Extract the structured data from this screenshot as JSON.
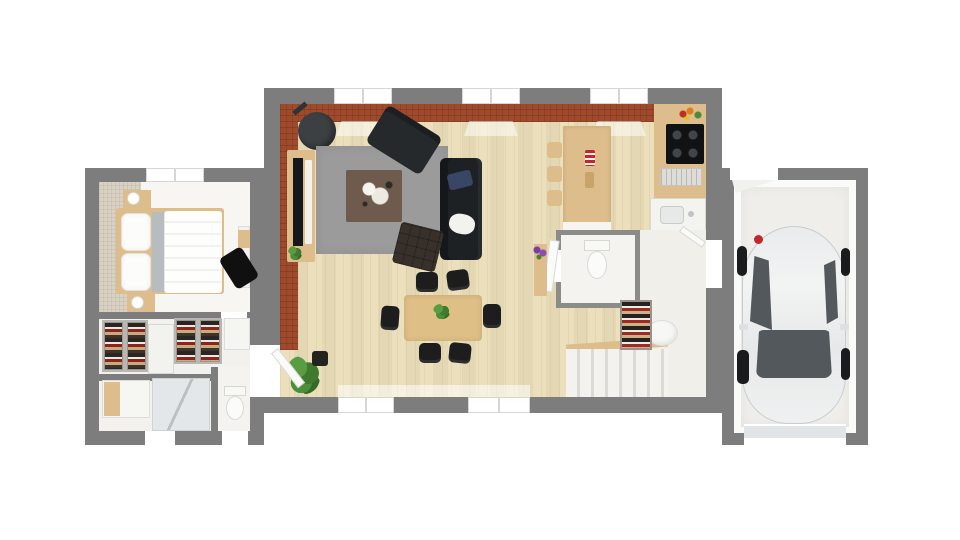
{
  "title": "3D rendered floor plan of a single-storey house with attached garage",
  "colors": {
    "wall": "#7d7d7d",
    "wood_floor": "#eaddb8",
    "brick": "#a04a2c",
    "rug_living": "#9b9b9b",
    "rug_bedroom": "#d9d1c2",
    "bedroom_floor": "#f7f6f3",
    "suite_floor": "#f2f1ed",
    "hall_floor": "#f1efea",
    "garage_floor": "#efeeeb",
    "garage_door": "#e2e5e7",
    "car_body": "#ebedee",
    "car_glass": "#53585c",
    "wheel": "#1a1b1d",
    "sofa": "#26292c",
    "sofa2": "#1e2124",
    "ottoman": "#38302b",
    "coffee_table": "#6e5b4e",
    "wood": "#dcbd8b",
    "dining_table": "#debf86",
    "chair": "#1d1d1d",
    "plant": "#4a8a38",
    "stove": "#3c4043",
    "cooktop": "#101214",
    "logo_red": "#c1272d",
    "pillow_blue": "#3a4666",
    "blanket_gray": "#b7bcc0",
    "shower_glass": "#e3e7e9",
    "stairs_step": "#dcdad4",
    "stairs_bg": "#f3f2ee",
    "window_frame": "#d6d6d2"
  },
  "rooms": [
    {
      "id": "living-dining",
      "furniture": [
        "wood-stove",
        "tv-console",
        "area-rug",
        "coffee-table",
        "two-seat-sofa",
        "three-seat-sofa",
        "ottoman",
        "dining-table",
        "6 dining-chairs",
        "potted-plant"
      ]
    },
    {
      "id": "kitchen",
      "furniture": [
        "island",
        "3 bar-stools",
        "counter",
        "cooktop",
        "dish-rack",
        "sink",
        "vegetables"
      ]
    },
    {
      "id": "bedroom",
      "furniture": [
        "double-bed",
        "2 nightstands",
        "2 lamps",
        "desk",
        "desk-chair",
        "rug"
      ]
    },
    {
      "id": "dressing",
      "furniture": [
        "2 wardrobes",
        "sliding-door"
      ]
    },
    {
      "id": "bathroom",
      "furniture": [
        "vanity",
        "shower",
        "toilet"
      ]
    },
    {
      "id": "wc",
      "furniture": [
        "toilet",
        "flower-shelf"
      ]
    },
    {
      "id": "entry-hall",
      "furniture": [
        "shoe-rack",
        "laundry-basket",
        "staircase",
        "doors"
      ]
    },
    {
      "id": "garage",
      "furniture": [
        "car",
        "garage-door"
      ]
    }
  ]
}
